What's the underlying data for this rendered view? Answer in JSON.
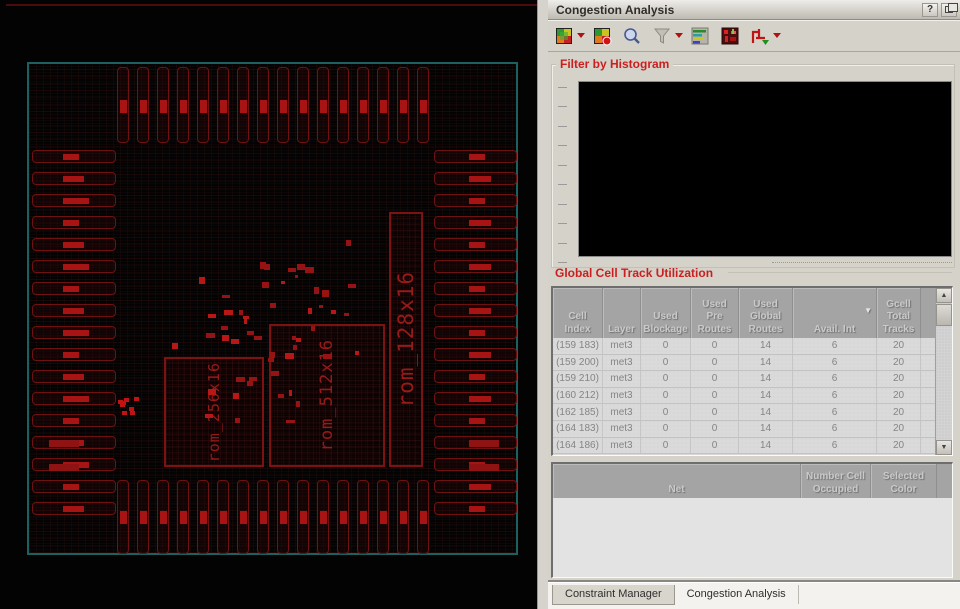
{
  "panel": {
    "title": "Congestion Analysis",
    "help_label": "?",
    "toolbar": {
      "icons": [
        "congestion-heatmap",
        "congestion-heatmap-save",
        "zoom",
        "filter",
        "histogram-display",
        "hotspot-map",
        "route-display"
      ]
    }
  },
  "histogram_section": {
    "title": "Filter by Histogram"
  },
  "utilization_section": {
    "title": "Global Cell Track Utilization",
    "columns": [
      "Cell\nIndex",
      "Layer",
      "Used\nBlockage",
      "Used\nPre\nRoutes",
      "Used\nGlobal\nRoutes",
      "Avail. Int",
      "Gcell\nTotal\nTracks"
    ],
    "sort_column_index": 5,
    "sort_indicator": "▼",
    "rows": [
      [
        "(159 183)",
        "met3",
        "0",
        "0",
        "14",
        "6",
        "20"
      ],
      [
        "(159 200)",
        "met3",
        "0",
        "0",
        "14",
        "6",
        "20"
      ],
      [
        "(159 210)",
        "met3",
        "0",
        "0",
        "14",
        "6",
        "20"
      ],
      [
        "(160 212)",
        "met3",
        "0",
        "0",
        "14",
        "6",
        "20"
      ],
      [
        "(162 185)",
        "met3",
        "0",
        "0",
        "14",
        "6",
        "20"
      ],
      [
        "(164 183)",
        "met3",
        "0",
        "0",
        "14",
        "6",
        "20"
      ],
      [
        "(164 186)",
        "met3",
        "0",
        "0",
        "14",
        "6",
        "20"
      ]
    ]
  },
  "net_section": {
    "columns": [
      "Net",
      "Number Cell\nOccupied",
      "Selected\nColor"
    ]
  },
  "tabs": [
    "Constraint Manager",
    "Congestion Analysis"
  ],
  "layout_viewer": {
    "macros": [
      {
        "label": "rom_256x16"
      },
      {
        "label": "rom_512x16"
      },
      {
        "label": "rom_128x16"
      }
    ]
  },
  "colors": {
    "section_title_red": "#cb1f1f",
    "die_boundary_teal": "#1c6060",
    "pad_outline_red": "#6e1111",
    "pad_label_red": "#a81414",
    "panel_gray": "#d5d2ca",
    "histogram_bg": "#000000"
  }
}
